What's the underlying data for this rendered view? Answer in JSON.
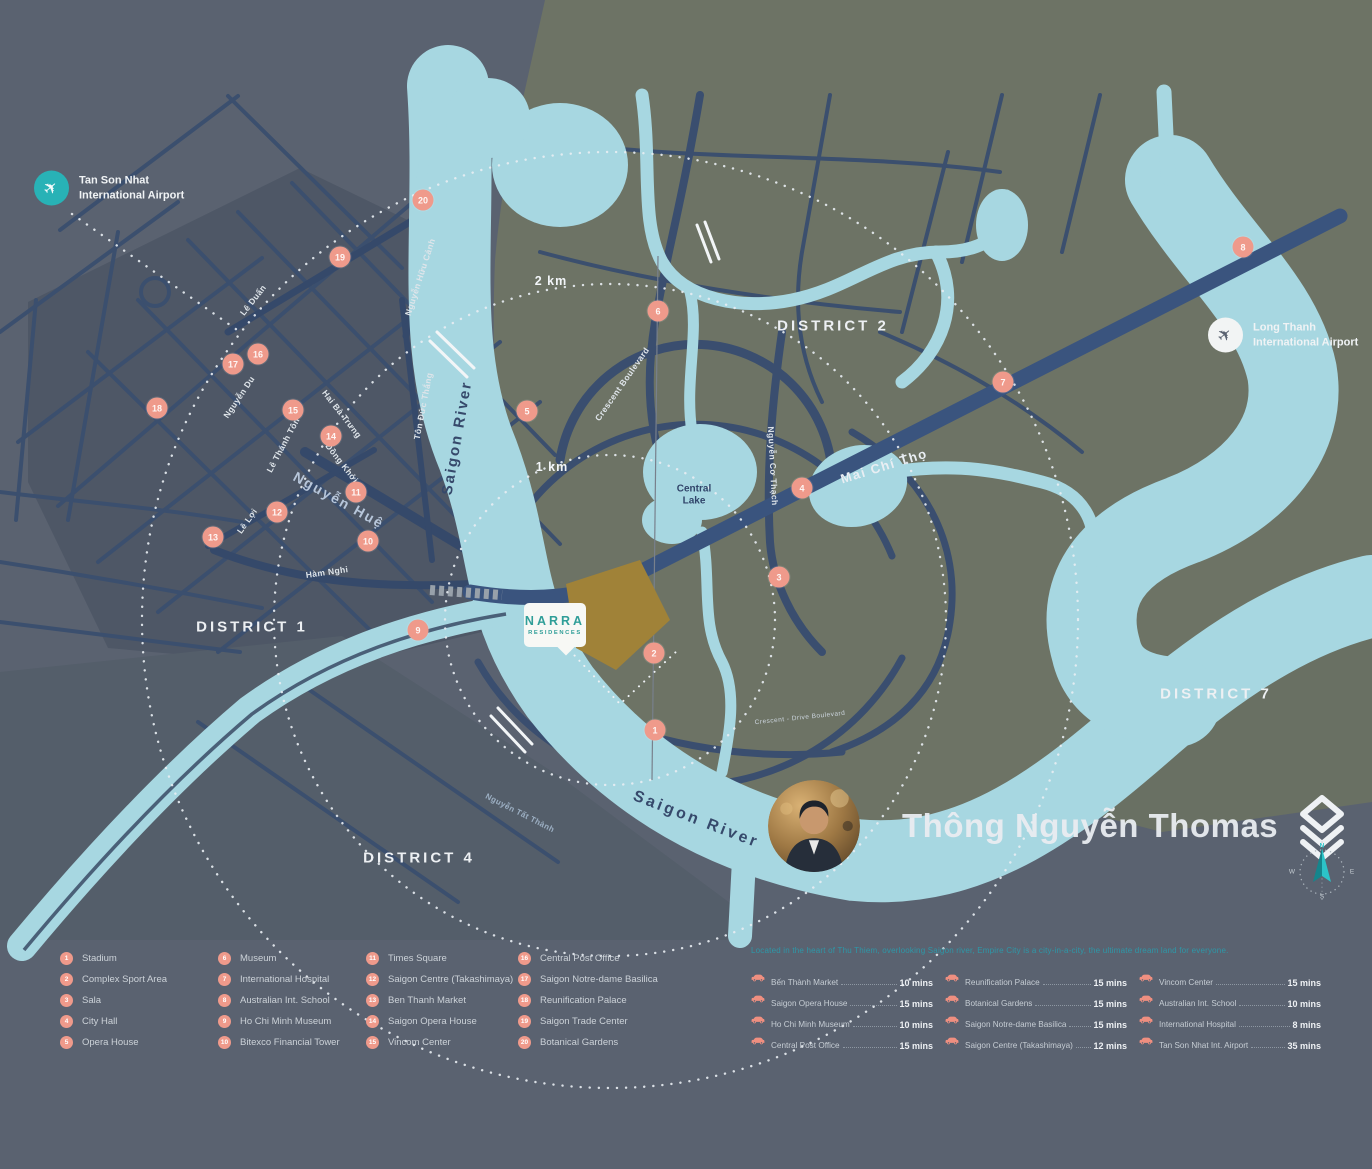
{
  "map": {
    "districts": [
      {
        "label": "DISTRICT 1",
        "x": 252,
        "y": 627
      },
      {
        "label": "DISTRICT  2",
        "x": 833,
        "y": 326
      },
      {
        "label": "DISTRICT 4",
        "x": 419,
        "y": 858
      },
      {
        "label": "DISTRICT 7",
        "x": 1216,
        "y": 694
      }
    ],
    "street_labels": [
      {
        "t": "Lê Duẩn",
        "x": 253,
        "y": 300,
        "r": -52,
        "v": "std"
      },
      {
        "t": "Nguyễn Du",
        "x": 239,
        "y": 397,
        "r": -56,
        "v": "std"
      },
      {
        "t": "Hai Bà Trưng",
        "x": 342,
        "y": 414,
        "r": 52,
        "v": "std"
      },
      {
        "t": "Lê Thánh Tôn",
        "x": 283,
        "y": 445,
        "r": -62,
        "v": "std"
      },
      {
        "t": "Đồng Khởi",
        "x": 342,
        "y": 463,
        "r": 52,
        "v": "std"
      },
      {
        "t": "Nguyễn Huệ",
        "x": 339,
        "y": 500,
        "r": 29,
        "v": "blvd"
      },
      {
        "t": "Lê Lợi",
        "x": 247,
        "y": 521,
        "r": -55,
        "v": "std"
      },
      {
        "t": "Hàm Nghi",
        "x": 327,
        "y": 572,
        "r": -8,
        "v": "std"
      },
      {
        "t": "Tôn Đức Thắng",
        "x": 423,
        "y": 406,
        "r": -79,
        "v": "std"
      },
      {
        "t": "Saigon River",
        "x": 457,
        "y": 438,
        "r": -80,
        "v": "river"
      },
      {
        "t": "Nguyễn Hữu Cảnh",
        "x": 420,
        "y": 277,
        "r": -72,
        "v": "std"
      },
      {
        "t": "Crescent Boulevard",
        "x": 622,
        "y": 384,
        "r": -55,
        "v": "std"
      },
      {
        "t": "Nguyễn Cơ Thạch",
        "x": 773,
        "y": 466,
        "r": 87,
        "v": "std"
      },
      {
        "t": "Mai Chí Thọ",
        "x": 884,
        "y": 466,
        "r": -17,
        "v": "hwy"
      },
      {
        "t": "Crescent - Drive Boulevard",
        "x": 800,
        "y": 718,
        "r": -6,
        "v": "tiny"
      },
      {
        "t": "Nguyễn Tất Thành",
        "x": 520,
        "y": 813,
        "r": 27,
        "v": "dim"
      },
      {
        "t": "Saigon River",
        "x": 696,
        "y": 820,
        "r": 21,
        "v": "river-lg"
      }
    ],
    "scale_rings": [
      {
        "label": "2 km",
        "x": 551,
        "y": 281
      },
      {
        "label": "1 km",
        "x": 552,
        "y": 467
      }
    ],
    "central_lake": {
      "line1": "Central",
      "line2": "Lake",
      "x": 694,
      "y": 495
    },
    "airports": [
      {
        "line1": "Tan Son Nhat",
        "line2": "International Airport",
        "x": 34,
        "y": 188,
        "variant": "teal"
      },
      {
        "line1": "Long Thanh",
        "line2": "International Airport",
        "x": 1208,
        "y": 335,
        "variant": "white"
      }
    ],
    "markers": [
      {
        "n": "1",
        "x": 655,
        "y": 730
      },
      {
        "n": "2",
        "x": 654,
        "y": 653
      },
      {
        "n": "3",
        "x": 779,
        "y": 577
      },
      {
        "n": "4",
        "x": 802,
        "y": 488
      },
      {
        "n": "5",
        "x": 527,
        "y": 411
      },
      {
        "n": "6",
        "x": 658,
        "y": 311
      },
      {
        "n": "7",
        "x": 1003,
        "y": 382
      },
      {
        "n": "8",
        "x": 1243,
        "y": 247
      },
      {
        "n": "9",
        "x": 418,
        "y": 630
      },
      {
        "n": "10",
        "x": 368,
        "y": 541
      },
      {
        "n": "11",
        "x": 356,
        "y": 492
      },
      {
        "n": "12",
        "x": 277,
        "y": 512
      },
      {
        "n": "13",
        "x": 213,
        "y": 537
      },
      {
        "n": "14",
        "x": 331,
        "y": 436
      },
      {
        "n": "15",
        "x": 293,
        "y": 410
      },
      {
        "n": "16",
        "x": 258,
        "y": 354
      },
      {
        "n": "17",
        "x": 233,
        "y": 364
      },
      {
        "n": "18",
        "x": 157,
        "y": 408
      },
      {
        "n": "19",
        "x": 340,
        "y": 257
      },
      {
        "n": "20",
        "x": 423,
        "y": 200
      }
    ]
  },
  "project": {
    "name": "NARRA",
    "subtitle": "RESIDENCES"
  },
  "watermark": {
    "name": "Thông Nguyễn Thomas"
  },
  "compass": {
    "n": "N",
    "e": "E",
    "w": "W",
    "s": "S"
  },
  "legend": {
    "columns": [
      [
        {
          "n": "1",
          "label": "Stadium"
        },
        {
          "n": "2",
          "label": "Complex Sport Area"
        },
        {
          "n": "3",
          "label": "Sala"
        },
        {
          "n": "4",
          "label": "City Hall"
        },
        {
          "n": "5",
          "label": "Opera House"
        }
      ],
      [
        {
          "n": "6",
          "label": "Museum"
        },
        {
          "n": "7",
          "label": "International Hospital"
        },
        {
          "n": "8",
          "label": "Australian Int. School"
        },
        {
          "n": "9",
          "label": "Ho Chi Minh Museum"
        },
        {
          "n": "10",
          "label": "Bitexco Financial Tower"
        }
      ],
      [
        {
          "n": "11",
          "label": "Times Square"
        },
        {
          "n": "12",
          "label": "Saigon Centre (Takashimaya)"
        },
        {
          "n": "13",
          "label": "Ben Thanh Market"
        },
        {
          "n": "14",
          "label": "Saigon Opera House"
        },
        {
          "n": "15",
          "label": "Vincom Center"
        }
      ],
      [
        {
          "n": "16",
          "label": "Central Post Office"
        },
        {
          "n": "17",
          "label": "Saigon Notre-dame Basilica"
        },
        {
          "n": "18",
          "label": "Reunification Palace"
        },
        {
          "n": "19",
          "label": "Saigon Trade Center"
        },
        {
          "n": "20",
          "label": "Botanical Gardens"
        }
      ]
    ]
  },
  "travel_times": {
    "intro": "Located in the heart of Thu Thiem, overlooking Saigon river, Empire City is a city-in-a-city, the ultimate dream land for everyone.",
    "columns": [
      [
        {
          "name": "Bến Thành Market",
          "time": "10 mins"
        },
        {
          "name": "Saigon Opera House",
          "time": "15 mins"
        },
        {
          "name": "Ho Chi Minh Museum",
          "time": "10 mins"
        },
        {
          "name": "Central Post Office",
          "time": "15 mins"
        }
      ],
      [
        {
          "name": "Reunification Palace",
          "time": "15 mins"
        },
        {
          "name": "Botanical Gardens",
          "time": "15 mins"
        },
        {
          "name": "Saigon Notre-dame Basilica",
          "time": "15 mins"
        },
        {
          "name": "Saigon Centre (Takashimaya)",
          "time": "12 mins"
        }
      ],
      [
        {
          "name": "Vincom Center",
          "time": "15 mins"
        },
        {
          "name": "Australian Int. School",
          "time": "10 mins"
        },
        {
          "name": "International Hospital",
          "time": "8 mins"
        },
        {
          "name": "Tan Son Nhat Int. Airport",
          "time": "35 mins"
        }
      ]
    ]
  },
  "colors": {
    "background_slate": "#5a6270",
    "district1_slate": "#4e5766",
    "land_olive": "#6d7365",
    "river_blue": "#a7d7e1",
    "road_navy": "#3b4f6e",
    "marker_salmon": "#ef9a8b",
    "accent_teal": "#28b2b6",
    "project_teal": "#2f9e98",
    "parcel_gold": "#a08238"
  }
}
